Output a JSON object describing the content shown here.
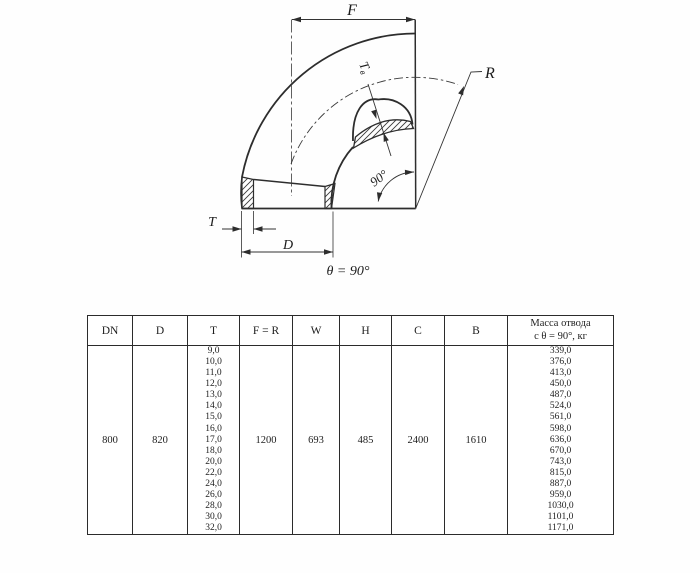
{
  "drawing": {
    "labels": {
      "f": "F",
      "r": "R",
      "t": "T",
      "d": "D",
      "tb_main": "T",
      "tb_sub": "в",
      "angle": "90°",
      "theta_note": "θ = 90°"
    }
  },
  "table": {
    "headers": [
      "DN",
      "D",
      "T",
      "F = R",
      "W",
      "H",
      "C",
      "B"
    ],
    "mass_header": [
      "Масса отвода",
      "с θ =  90°, кг"
    ],
    "row": {
      "dn": "800",
      "d": "820",
      "t_values": [
        "9,0",
        "10,0",
        "11,0",
        "12,0",
        "13,0",
        "14,0",
        "15,0",
        "16,0",
        "17,0",
        "18,0",
        "20,0",
        "22,0",
        "24,0",
        "26,0",
        "28,0",
        "30,0",
        "32,0"
      ],
      "f_r": "1200",
      "w": "693",
      "h": "485",
      "c": "2400",
      "b": "1610",
      "mass_values": [
        "339,0",
        "376,0",
        "413,0",
        "450,0",
        "487,0",
        "524,0",
        "561,0",
        "598,0",
        "636,0",
        "670,0",
        "743,0",
        "815,0",
        "887,0",
        "959,0",
        "1030,0",
        "1101,0",
        "1171,0"
      ]
    }
  }
}
